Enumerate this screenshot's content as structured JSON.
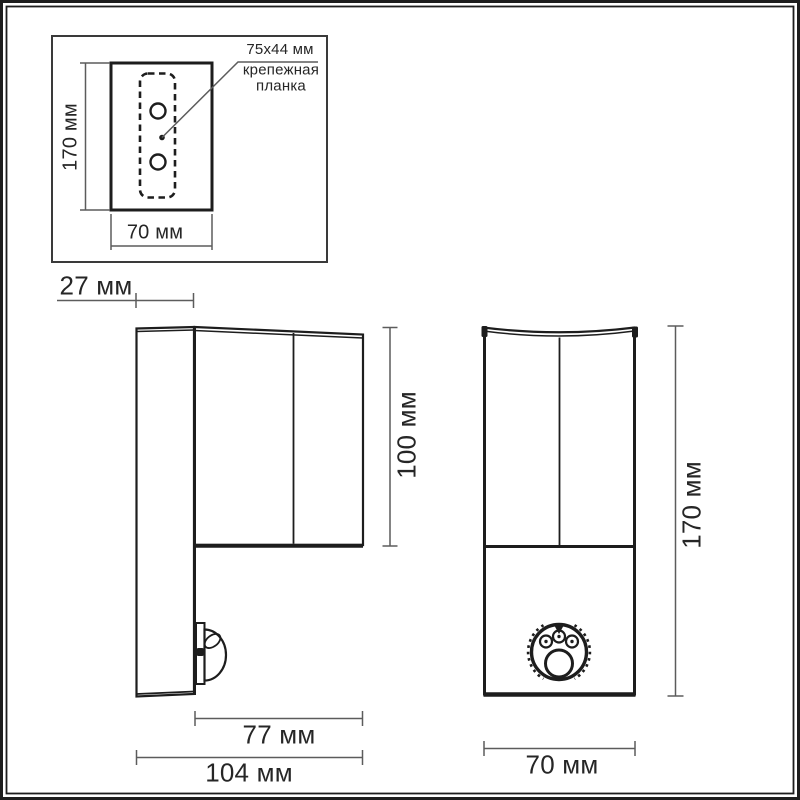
{
  "inset": {
    "height": "170 мм",
    "width": "70 мм",
    "bracket_size": "75x44 мм",
    "bracket_name": "крепежная планка"
  },
  "side_view": {
    "plate_depth": "27 мм",
    "head_height": "100 мм",
    "head_depth": "77 мм",
    "total_depth": "104 мм"
  },
  "front_view": {
    "height": "170 мм",
    "width": "70 мм"
  },
  "colors": {
    "ink": "#1d1d1d",
    "dim": "#5c5c5c",
    "text": "#262626",
    "background": "#ffffff"
  }
}
